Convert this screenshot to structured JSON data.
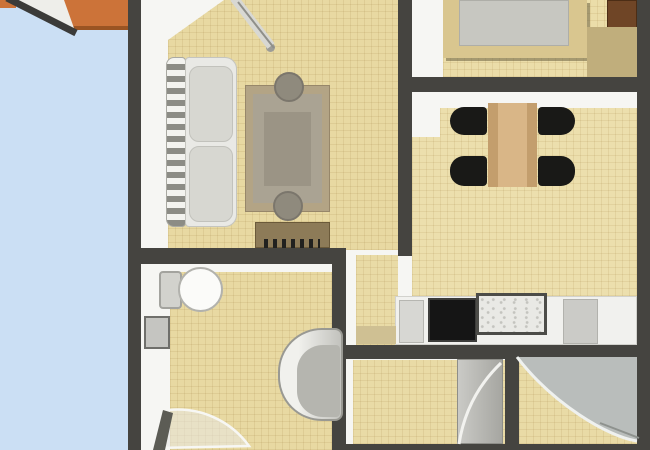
{
  "meta": {
    "scene": "apartment-floor-plan",
    "canvas": {
      "width": 650,
      "height": 450
    }
  },
  "palette": {
    "terrace_blue": "#cbdff4",
    "wall_dark": "#454440",
    "interior_white": "#f6f6f3",
    "floor_beige": "#e9dba6",
    "roof_orange": "#cc7339",
    "wood_light": "#d9b687",
    "wood_dark": "#6f4526",
    "appliance_black": "#151515",
    "fixture_gray": "#c6c6c1"
  },
  "plan": {
    "layers": [
      {
        "name": "terrace-floor",
        "x": 0,
        "y": 0,
        "w": 128,
        "h": 450,
        "css": {
          "background": "#cbdff4"
        }
      },
      {
        "name": "terrace-roof-corner",
        "x": 0,
        "y": 0,
        "w": 16,
        "h": 8,
        "css": {
          "background": "#cc7339"
        }
      },
      {
        "name": "terrace-roof-overhang",
        "x": 62,
        "y": 0,
        "w": 68,
        "h": 30,
        "css": {
          "background": "#cc7339",
          "borderBottom": "4px solid #9a5423",
          "borderLeft": "2px solid #9a5423"
        }
      },
      {
        "name": "apartment-interior",
        "x": 141,
        "y": 0,
        "w": 496,
        "h": 450,
        "css": {
          "background": "#f6f6f3"
        }
      },
      {
        "name": "living-room-floor",
        "x": 168,
        "y": 0,
        "w": 230,
        "h": 250,
        "css": {
          "background": "#e8d9a2",
          "backgroundImage": "repeating-linear-gradient(0deg, rgba(166,134,72,0.16) 0 1px, rgba(0,0,0,0) 1px 7px), repeating-linear-gradient(90deg, rgba(166,134,72,0.16) 0 1px, rgba(0,0,0,0) 1px 7px)",
          "clipPath": "polygon(56px 0, 230px 0, 230px 250px, 0 250px, 0 40px)"
        }
      },
      {
        "name": "bedroom-floor",
        "x": 443,
        "y": 0,
        "w": 194,
        "h": 77,
        "css": {
          "background": "#ebdda9",
          "backgroundImage": "repeating-linear-gradient(0deg, rgba(166,134,72,0.15) 0 1px, rgba(0,0,0,0) 1px 7px), repeating-linear-gradient(90deg, rgba(166,134,72,0.15) 0 1px, rgba(0,0,0,0) 1px 7px)"
        }
      },
      {
        "name": "dining-room-floor",
        "x": 412,
        "y": 108,
        "w": 225,
        "h": 237,
        "css": {
          "background": "#ecdfad",
          "backgroundImage": "repeating-linear-gradient(0deg, rgba(166,134,72,0.15) 0 1px, rgba(0,0,0,0) 1px 7px), repeating-linear-gradient(90deg, rgba(166,134,72,0.15) 0 1px, rgba(0,0,0,0) 1px 7px)"
        }
      },
      {
        "name": "dining-floor-notch",
        "x": 412,
        "y": 108,
        "w": 28,
        "h": 29,
        "css": {
          "background": "#f6f6f3"
        }
      },
      {
        "name": "corridor-floor",
        "x": 356,
        "y": 255,
        "w": 42,
        "h": 90,
        "css": {
          "background": "#e9dba6",
          "backgroundImage": "repeating-linear-gradient(0deg, rgba(166,134,72,0.15) 0 1px, rgba(0,0,0,0) 1px 7px), repeating-linear-gradient(90deg, rgba(166,134,72,0.15) 0 1px, rgba(0,0,0,0) 1px 7px)"
        }
      },
      {
        "name": "bathroom-floor",
        "x": 170,
        "y": 272,
        "w": 163,
        "h": 178,
        "css": {
          "background": "#e8d9a2",
          "backgroundImage": "repeating-linear-gradient(0deg, rgba(166,134,72,0.16) 0 1px, rgba(0,0,0,0) 1px 7px), repeating-linear-gradient(90deg, rgba(166,134,72,0.16) 0 1px, rgba(0,0,0,0) 1px 7px)"
        }
      },
      {
        "name": "hall-floor",
        "x": 353,
        "y": 360,
        "w": 152,
        "h": 84,
        "css": {
          "background": "#e9dba6",
          "backgroundImage": "repeating-linear-gradient(0deg, rgba(166,134,72,0.15) 0 1px, rgba(0,0,0,0) 1px 7px), repeating-linear-gradient(90deg, rgba(166,134,72,0.15) 0 1px, rgba(0,0,0,0) 1px 7px)"
        }
      },
      {
        "name": "shower-room-floor",
        "x": 519,
        "y": 355,
        "w": 118,
        "h": 89,
        "css": {
          "background": "#e9dba6",
          "backgroundImage": "repeating-linear-gradient(0deg, rgba(166,134,72,0.15) 0 1px, rgba(0,0,0,0) 1px 7px), repeating-linear-gradient(90deg, rgba(166,134,72,0.15) 0 1px, rgba(0,0,0,0) 1px 7px)"
        }
      },
      {
        "name": "exterior-wall-left",
        "x": 128,
        "y": 0,
        "w": 13,
        "h": 450,
        "css": {
          "background": "#454440"
        }
      },
      {
        "name": "exterior-wall-right",
        "x": 637,
        "y": 0,
        "w": 13,
        "h": 450,
        "css": {
          "background": "#454440"
        }
      },
      {
        "name": "living-dining-wall",
        "x": 398,
        "y": 0,
        "w": 14,
        "h": 256,
        "css": {
          "background": "#454440"
        }
      },
      {
        "name": "bedroom-south-wall",
        "x": 398,
        "y": 77,
        "w": 252,
        "h": 15,
        "css": {
          "background": "#454440"
        }
      },
      {
        "name": "living-south-wall",
        "x": 128,
        "y": 248,
        "w": 218,
        "h": 16,
        "css": {
          "background": "#454440"
        }
      },
      {
        "name": "bathroom-east-wall",
        "x": 332,
        "y": 248,
        "w": 14,
        "h": 202,
        "css": {
          "background": "#454440"
        }
      },
      {
        "name": "kitchen-south-wall",
        "x": 332,
        "y": 345,
        "w": 318,
        "h": 14,
        "css": {
          "background": "#454440"
        }
      },
      {
        "name": "hall-shower-divider-wall",
        "x": 505,
        "y": 355,
        "w": 14,
        "h": 95,
        "css": {
          "background": "#454440"
        }
      },
      {
        "name": "south-edge-wall",
        "x": 332,
        "y": 444,
        "w": 318,
        "h": 6,
        "css": {
          "background": "#454440"
        }
      },
      {
        "name": "bed-frame",
        "x": 443,
        "y": 0,
        "w": 144,
        "h": 58,
        "css": {
          "background": "#d9c68f",
          "boxShadow": "3px 3px 0 rgba(95,85,55,0.5)"
        }
      },
      {
        "name": "bed-mattress",
        "x": 459,
        "y": 0,
        "w": 110,
        "h": 46,
        "css": {
          "background": "#c7c7c1",
          "border": "1px solid #aeaea8"
        }
      },
      {
        "name": "wardrobe",
        "x": 607,
        "y": 0,
        "w": 30,
        "h": 36,
        "css": {
          "background": "#6f4526",
          "border": "1px solid #4c2d15"
        }
      },
      {
        "name": "bedroom-chest",
        "x": 587,
        "y": 27,
        "w": 50,
        "h": 50,
        "css": {
          "background": "#c0ae7c"
        }
      },
      {
        "name": "sofa-armrest",
        "x": 166,
        "y": 57,
        "w": 20,
        "h": 170,
        "css": {
          "background": "repeating-linear-gradient(180deg, #f3f3ef 0 6px, #8c8c85 6px 12px)",
          "borderRadius": "8px 4px 4px 8px",
          "border": "1px solid #a9a9a2"
        }
      },
      {
        "name": "sofa-body",
        "x": 185,
        "y": 57,
        "w": 52,
        "h": 170,
        "css": {
          "background": "#e9e9e5",
          "border": "1px solid #c5c5bf",
          "borderRadius": "4px 12px 12px 4px"
        }
      },
      {
        "name": "sofa-cushion-top",
        "x": 189,
        "y": 66,
        "w": 44,
        "h": 76,
        "css": {
          "background": "#d7d7d1",
          "border": "1px solid #c2c2bc",
          "borderRadius": "10px"
        }
      },
      {
        "name": "sofa-cushion-bottom",
        "x": 189,
        "y": 146,
        "w": 44,
        "h": 76,
        "css": {
          "background": "#d7d7d1",
          "border": "1px solid #c2c2bc",
          "borderRadius": "10px"
        }
      },
      {
        "name": "coffee-table",
        "x": 245,
        "y": 85,
        "w": 85,
        "h": 127,
        "css": {
          "background": "#b3a485",
          "border": "1px solid #97876a"
        }
      },
      {
        "name": "coffee-table-top",
        "x": 253,
        "y": 94,
        "w": 69,
        "h": 109,
        "css": {
          "background": "#aaa393"
        }
      },
      {
        "name": "coffee-table-panel",
        "x": 264,
        "y": 112,
        "w": 47,
        "h": 74,
        "css": {
          "background": "#9b9485"
        }
      },
      {
        "name": "stool-top",
        "x": 274,
        "y": 72,
        "w": 30,
        "h": 30,
        "css": {
          "background": "#8f8a7d",
          "border": "2px solid #7b766c",
          "borderRadius": "50%"
        }
      },
      {
        "name": "stool-bottom",
        "x": 273,
        "y": 191,
        "w": 30,
        "h": 30,
        "css": {
          "background": "#8f8a7d",
          "border": "2px solid #7b766c",
          "borderRadius": "50%"
        }
      },
      {
        "name": "sideboard",
        "x": 255,
        "y": 222,
        "w": 75,
        "h": 26,
        "css": {
          "background": "#8d7b58",
          "border": "1px solid #6b5a3a"
        }
      },
      {
        "name": "sideboard-keys",
        "x": 264,
        "y": 239,
        "w": 56,
        "h": 9,
        "css": {
          "background": "repeating-linear-gradient(90deg, #21211f 0 4px, rgba(0,0,0,0) 4px 9px)"
        }
      },
      {
        "name": "dining-table",
        "x": 488,
        "y": 103,
        "w": 49,
        "h": 84,
        "css": {
          "background": "linear-gradient(90deg, #c39e6d 0 10px, #d9b687 10px 39px, #c39e6d 39px)"
        }
      },
      {
        "name": "dining-chair-top-left",
        "x": 450,
        "y": 107,
        "w": 37,
        "h": 28,
        "css": {
          "background": "#191917",
          "borderRadius": "14px 4px 4px 14px"
        }
      },
      {
        "name": "dining-chair-bottom-left",
        "x": 450,
        "y": 156,
        "w": 37,
        "h": 30,
        "css": {
          "background": "#191917",
          "borderRadius": "14px 4px 4px 14px"
        }
      },
      {
        "name": "dining-chair-top-right",
        "x": 538,
        "y": 107,
        "w": 37,
        "h": 28,
        "css": {
          "background": "#191917",
          "borderRadius": "4px 14px 14px 4px"
        }
      },
      {
        "name": "dining-chair-bottom-right",
        "x": 538,
        "y": 156,
        "w": 37,
        "h": 30,
        "css": {
          "background": "#191917",
          "borderRadius": "4px 14px 14px 4px"
        }
      },
      {
        "name": "kitchen-counter",
        "x": 395,
        "y": 296,
        "w": 242,
        "h": 49,
        "css": {
          "background": "#f1f1ee",
          "border": "1px solid #d2d2cd"
        }
      },
      {
        "name": "kitchen-cabinet",
        "x": 399,
        "y": 300,
        "w": 25,
        "h": 43,
        "css": {
          "background": "#d7d7d3",
          "border": "1px solid #b6b6b1"
        }
      },
      {
        "name": "stove",
        "x": 428,
        "y": 298,
        "w": 49,
        "h": 44,
        "css": {
          "background": "#151515",
          "border": "2px solid #3d3d3b"
        }
      },
      {
        "name": "kitchen-sink",
        "x": 476,
        "y": 293,
        "w": 71,
        "h": 42,
        "css": {
          "background": "#e9e9e5",
          "border": "3px solid #4c4c48",
          "backgroundImage": "radial-gradient(circle at 30% 40%, #c4c4bf 1px, rgba(0,0,0,0) 1.8px), radial-gradient(circle at 70% 65%, #c4c4bf 1px, rgba(0,0,0,0) 1.8px)",
          "backgroundSize": "11px 9px, 13px 10px"
        }
      },
      {
        "name": "counter-appliance",
        "x": 563,
        "y": 299,
        "w": 35,
        "h": 45,
        "css": {
          "background": "#cbcbc7",
          "border": "1px solid #b2b2ad"
        }
      },
      {
        "name": "kitchen-mat",
        "x": 356,
        "y": 326,
        "w": 40,
        "h": 18,
        "css": {
          "background": "#cfc093"
        }
      },
      {
        "name": "toilet-tank",
        "x": 159,
        "y": 271,
        "w": 23,
        "h": 38,
        "css": {
          "background": "#d2d2cd",
          "border": "2px solid #a3a39e",
          "borderRadius": "4px"
        }
      },
      {
        "name": "toilet-bowl",
        "x": 178,
        "y": 267,
        "w": 45,
        "h": 45,
        "css": {
          "background": "#fbfbf9",
          "border": "2px solid #b2b2ad",
          "borderRadius": "50%"
        }
      },
      {
        "name": "bathroom-sink",
        "x": 144,
        "y": 316,
        "w": 26,
        "h": 33,
        "css": {
          "background": "#c5c5c1",
          "border": "2px solid #6f6f6b"
        }
      },
      {
        "name": "bathtub",
        "x": 278,
        "y": 328,
        "w": 65,
        "h": 93,
        "css": {
          "background": "linear-gradient(90deg, #f1f1ed 0 30%, #c2c2bd)",
          "border": "2px solid #999993",
          "borderRadius": "44px 8px 8px 44px"
        }
      },
      {
        "name": "bathtub-inner",
        "x": 297,
        "y": 345,
        "w": 43,
        "h": 72,
        "css": {
          "background": "#b5b5af",
          "borderRadius": "26px 4px 4px 26px"
        }
      },
      {
        "name": "hall-door-leaf",
        "x": 457,
        "y": 359,
        "w": 46,
        "h": 85,
        "css": {
          "background": "linear-gradient(90deg, #cacac6, #a6a6a1)",
          "border": "1px solid #8e8e89"
        }
      },
      {
        "name": "living-door-handle",
        "x": 266,
        "y": 43,
        "w": 9,
        "h": 9,
        "css": {
          "background": "#9c9c97",
          "borderRadius": "50%"
        }
      }
    ],
    "paths": [
      {
        "name": "terrace-roof-gap",
        "d": "M14,0 L64,0 L75,31 Z",
        "fill": "#eeeeea"
      },
      {
        "name": "terrace-roof-edge-diagonal",
        "d": "M7,-2 L76,33",
        "stroke": "#3b3b39",
        "strokeWidth": 7
      },
      {
        "name": "living-door-leaf",
        "d": "M234,-2 L271,46",
        "stroke": "#d8d8d3",
        "strokeWidth": 9
      },
      {
        "name": "living-door-leaf-edge",
        "d": "M238,2 L274,48",
        "stroke": "#8f8f8a",
        "strokeWidth": 2
      },
      {
        "name": "bathroom-door-swing",
        "d": "M157,448 L169,410 A88,88 0 0 1 249,446 Z",
        "fill": "rgba(232,232,227,0.55)",
        "stroke": "#f7f7f4",
        "strokeWidth": 2.5
      },
      {
        "name": "bathroom-door-leaf",
        "d": "M153,450 L163,410 L173,413 L165,450 Z",
        "fill": "#5c5c55"
      },
      {
        "name": "hall-door-swing",
        "d": "M459,444 C464,412 478,385 501,363",
        "stroke": "#f2f2ef",
        "strokeWidth": 3
      },
      {
        "name": "corner-shower",
        "d": "M519,357 L637,357 L637,441 C608,437 552,403 517,357 Z",
        "fill": "#b9bdbb"
      },
      {
        "name": "corner-shower-rim",
        "d": "M517,357 C552,403 608,437 637,441",
        "stroke": "#eff1ef",
        "strokeWidth": 3
      },
      {
        "name": "corner-shower-edge",
        "d": "M600,423 L639,438",
        "stroke": "#8e928e",
        "strokeWidth": 2
      }
    ]
  }
}
